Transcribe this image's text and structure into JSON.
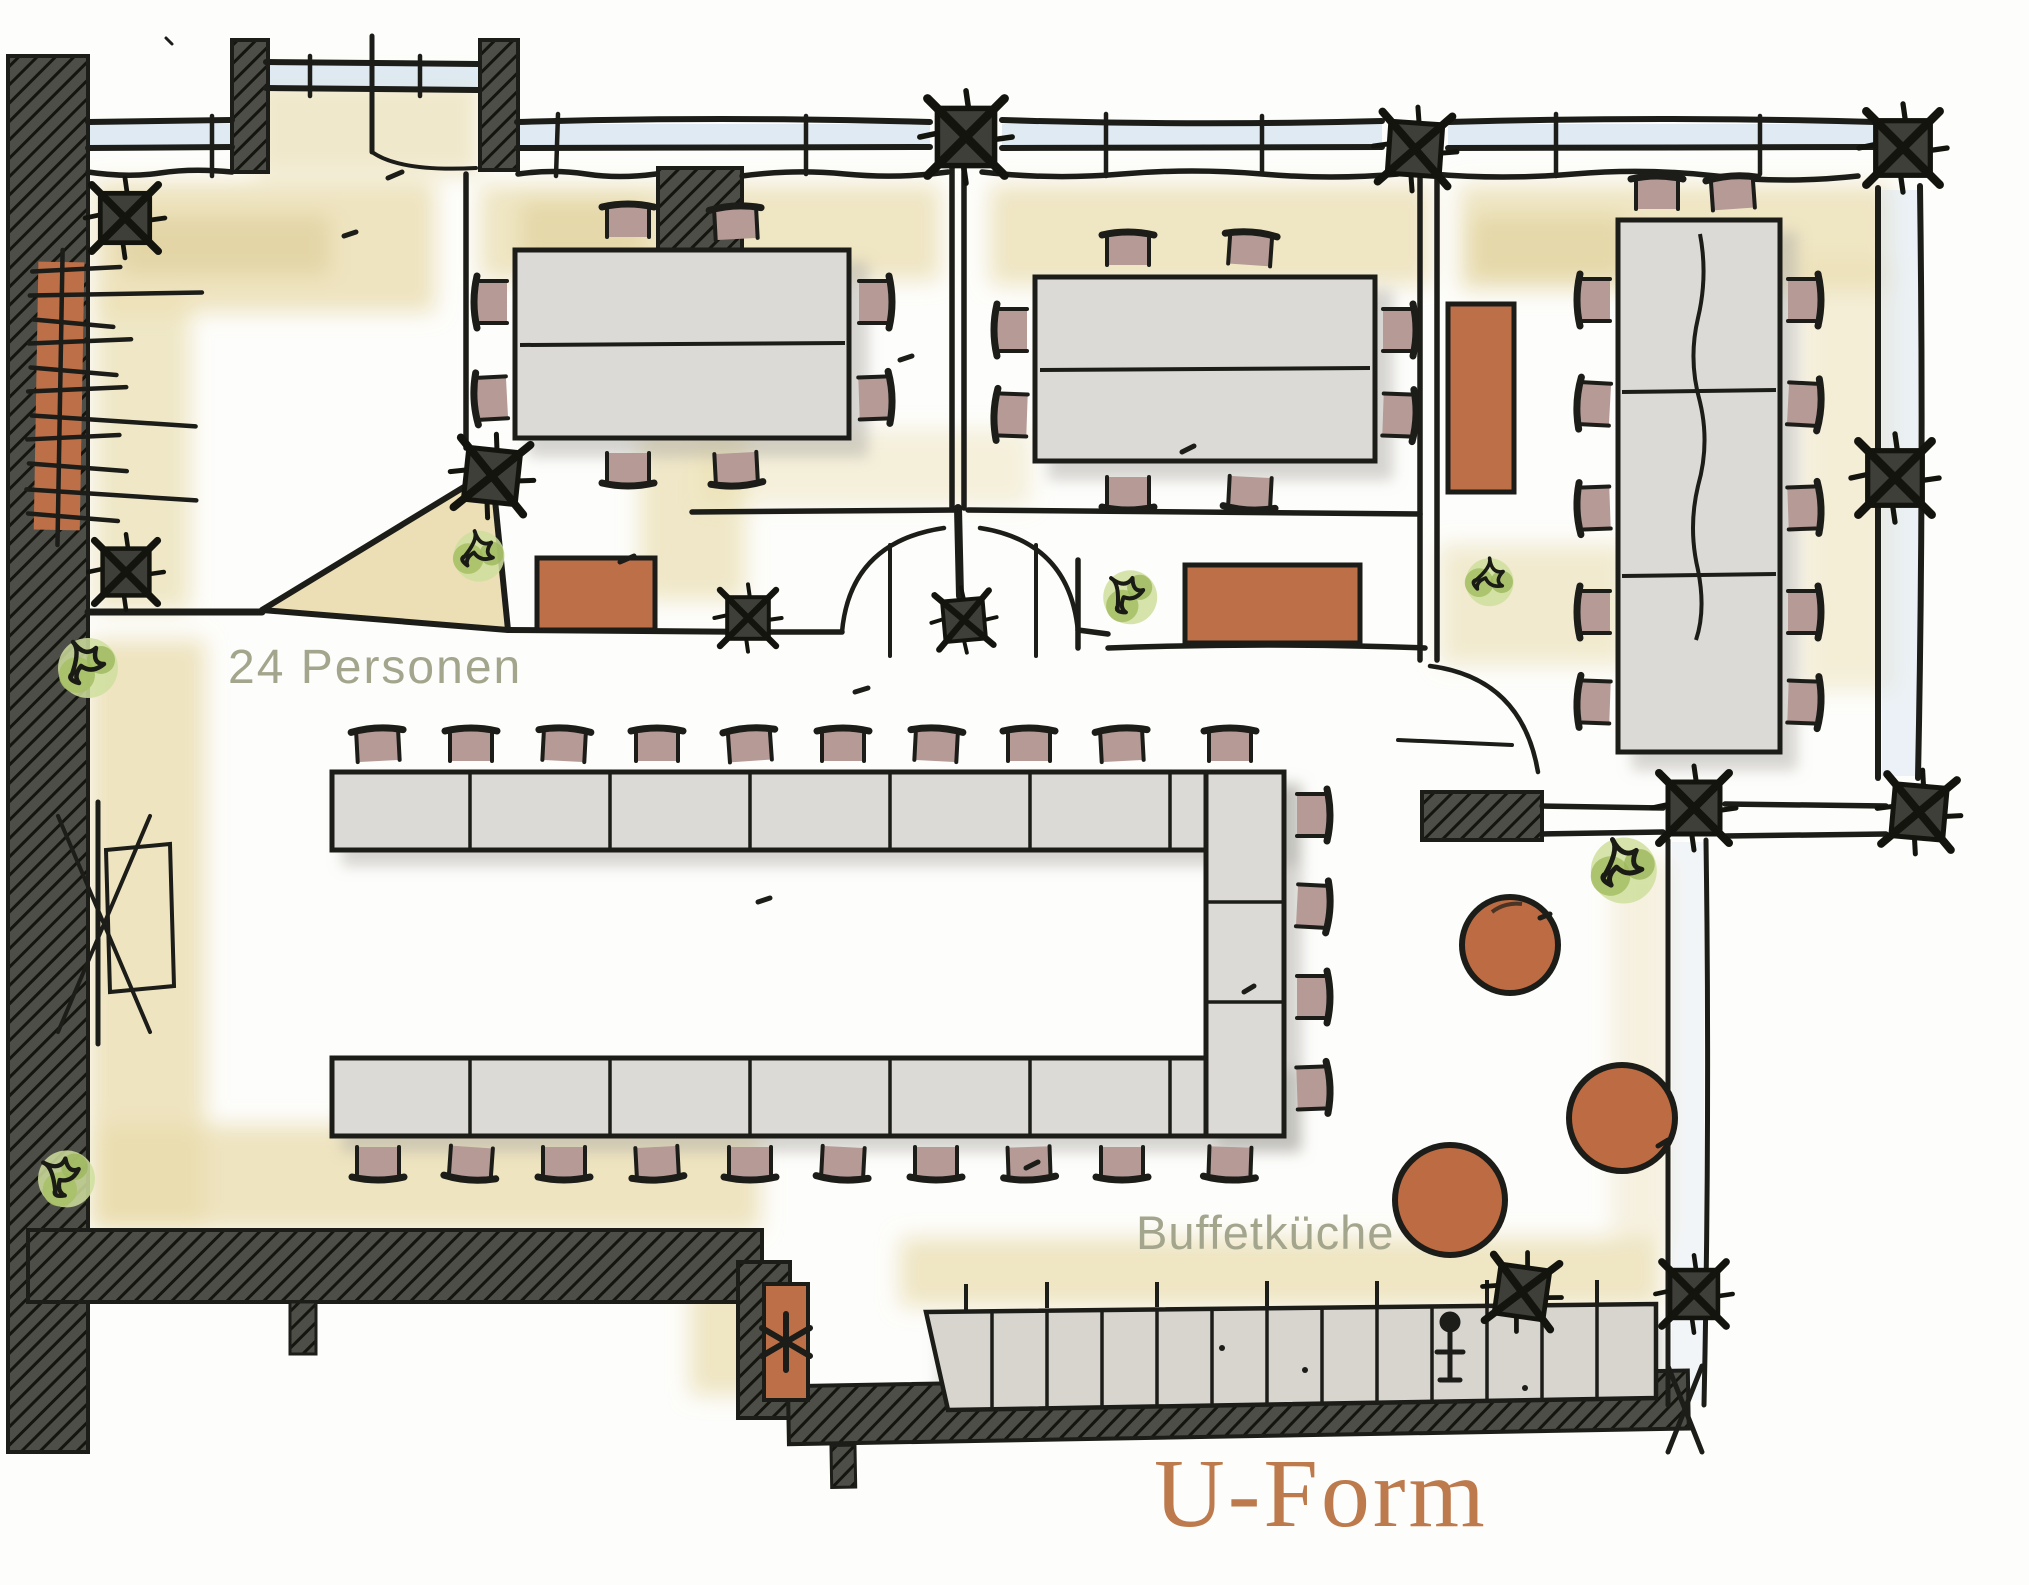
{
  "drawing": {
    "type": "hand-drawn floor plan marker sketch",
    "labels": {
      "capacity": "24 Personen",
      "buffet": "Buffetküche",
      "title": "U-Form"
    },
    "colors": {
      "ink": "#1c1c18",
      "wall_fill": "#4b4b45",
      "window_glass": "#d9e6f1",
      "wash_beige": "#e8dbab",
      "table_top": "#dbdad7",
      "chair_upholstery": "#b59a96",
      "sideboard_terracotta": "#bd7048",
      "bistro_table_orange": "#bd6b42",
      "plant_green": "#a9c167",
      "label_olive": "#a3a58c",
      "title_brown": "#bd7a4c"
    },
    "seating": {
      "u_table_seats": 24,
      "meeting_room_1_seats": 8,
      "meeting_room_2_seats": 8,
      "meeting_room_3_seats": 12,
      "bistro_tables": 3
    }
  }
}
